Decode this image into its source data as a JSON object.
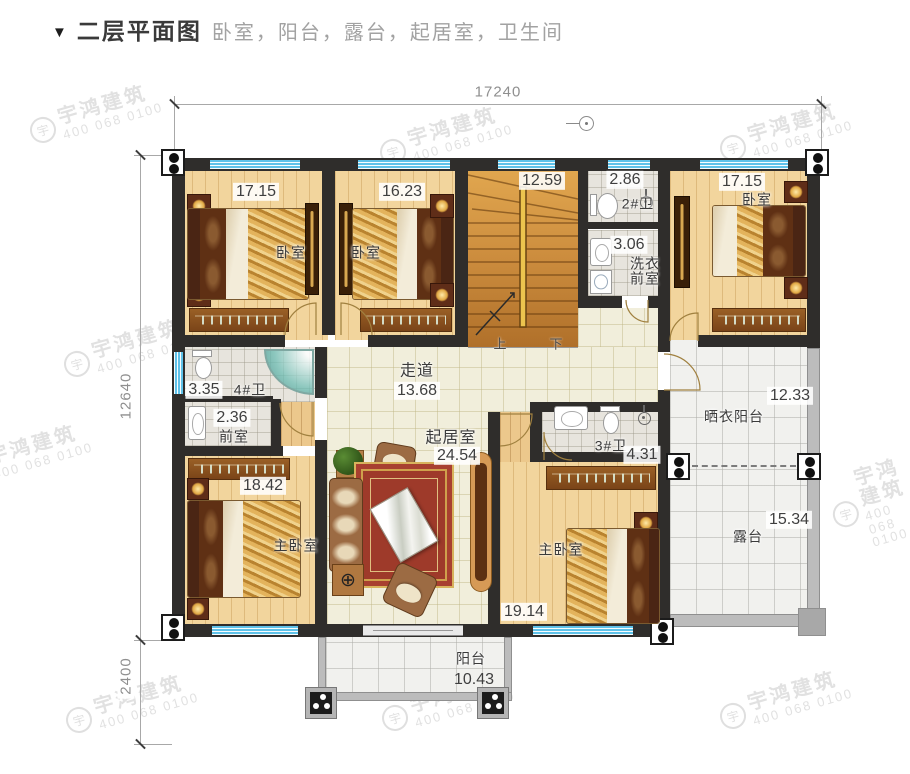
{
  "title": {
    "marker": "▼",
    "text": "二层平面图",
    "subtitle": "卧室，阳台，露台，起居室，卫生间"
  },
  "watermark": {
    "brand": "宇鸿建筑",
    "phone": "400 068 0100",
    "logo": "宇"
  },
  "dimensions": {
    "top_width": "17240",
    "left_height": "12640",
    "left_lower": "2400"
  },
  "rooms": {
    "bedroom_a": {
      "name": "卧室",
      "area": "17.15"
    },
    "bedroom_b": {
      "name": "卧室",
      "area": "16.23"
    },
    "bedroom_c": {
      "name": "卧室",
      "area": "17.15"
    },
    "stairs": {
      "area": "12.59",
      "up_label": "上",
      "down_label": "下"
    },
    "bath_2": {
      "name": "2#卫",
      "area": "2.86"
    },
    "laundry": {
      "name_line1": "洗衣",
      "name_line2": "前室",
      "area": "3.06"
    },
    "bath_4": {
      "name": "4#卫",
      "area": "3.35"
    },
    "anteroom": {
      "name": "前室",
      "area": "2.36"
    },
    "corridor": {
      "name": "走道",
      "area": "13.68"
    },
    "living_room": {
      "name": "起居室",
      "area": "24.54"
    },
    "bath_3": {
      "name": "3#卫",
      "area": "4.31"
    },
    "drying_balcony": {
      "name": "晒衣阳台",
      "area": "12.33"
    },
    "master_left": {
      "name": "主卧室",
      "area": "18.42"
    },
    "master_right": {
      "name": "主卧室",
      "area": "19.14"
    },
    "terrace": {
      "name": "露台",
      "area": "15.34"
    },
    "balcony": {
      "name": "阳台",
      "area": "10.43"
    }
  },
  "colors": {
    "wall": "#2f2d2b",
    "window": "#5fc2e9",
    "wood_floor": "#f2d59d",
    "tile": "#f1eedb",
    "bath_tile": "#e7e4dd",
    "outdoor_tile": "#f1f1ee",
    "carpet": "#9e3a2a",
    "stair_wood": "#cf9040",
    "railing": "#bcbcbc",
    "dimension": "#8f8f8f",
    "watermark": "#c9c9c9"
  }
}
